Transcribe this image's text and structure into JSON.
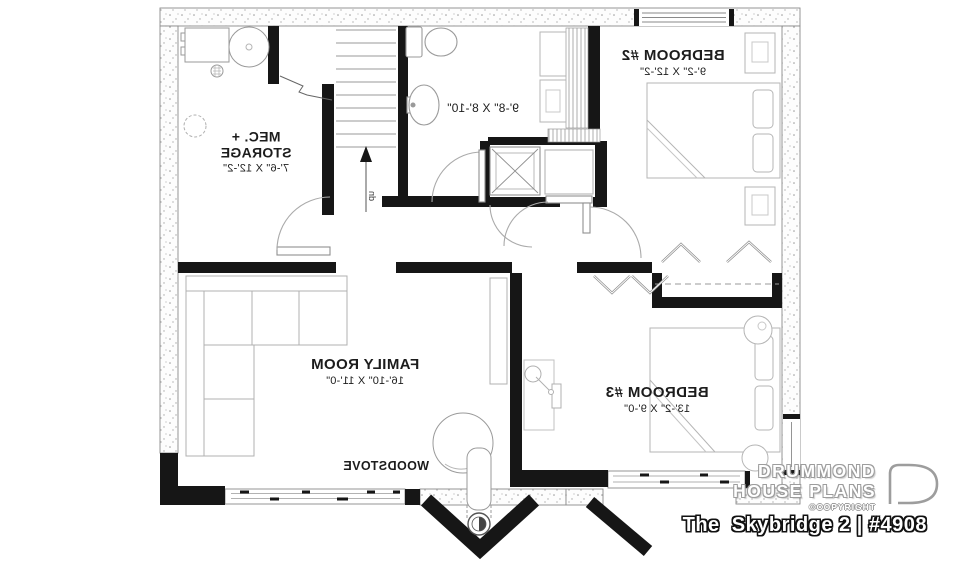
{
  "plan": {
    "rooms": {
      "mec": {
        "line1": "MEC. +",
        "line2": "STORAGE",
        "dims": "7'-6\" X 12'-2\""
      },
      "bath": {
        "dims": "9'-8\" X 8'-10\""
      },
      "bedroom2": {
        "name": "BEDROOM #2",
        "dims": "9'-2\" X 12'-2\""
      },
      "family": {
        "name": "FAMILY ROOM",
        "dims": "16'-10\" X 11'-0\""
      },
      "bedroom3": {
        "name": "BEDROOM #3",
        "dims": "13'-2\" X 9'-0\""
      }
    },
    "annotations": {
      "woodstove": "WOODSTOVE",
      "stair_direction": "up"
    }
  },
  "branding": {
    "name_line1": "DRUMMOND",
    "name_line2": "HOUSE PLANS",
    "copyright_label": "©COPYRIGHT"
  },
  "footer": {
    "plan_title": "The  Skybridge 2 | #4908"
  },
  "colors": {
    "wall": "#161616",
    "foundation_stroke": "#8a8a8a",
    "furniture_line": "#a8a8a8",
    "label_text": "#1c1c1c"
  }
}
